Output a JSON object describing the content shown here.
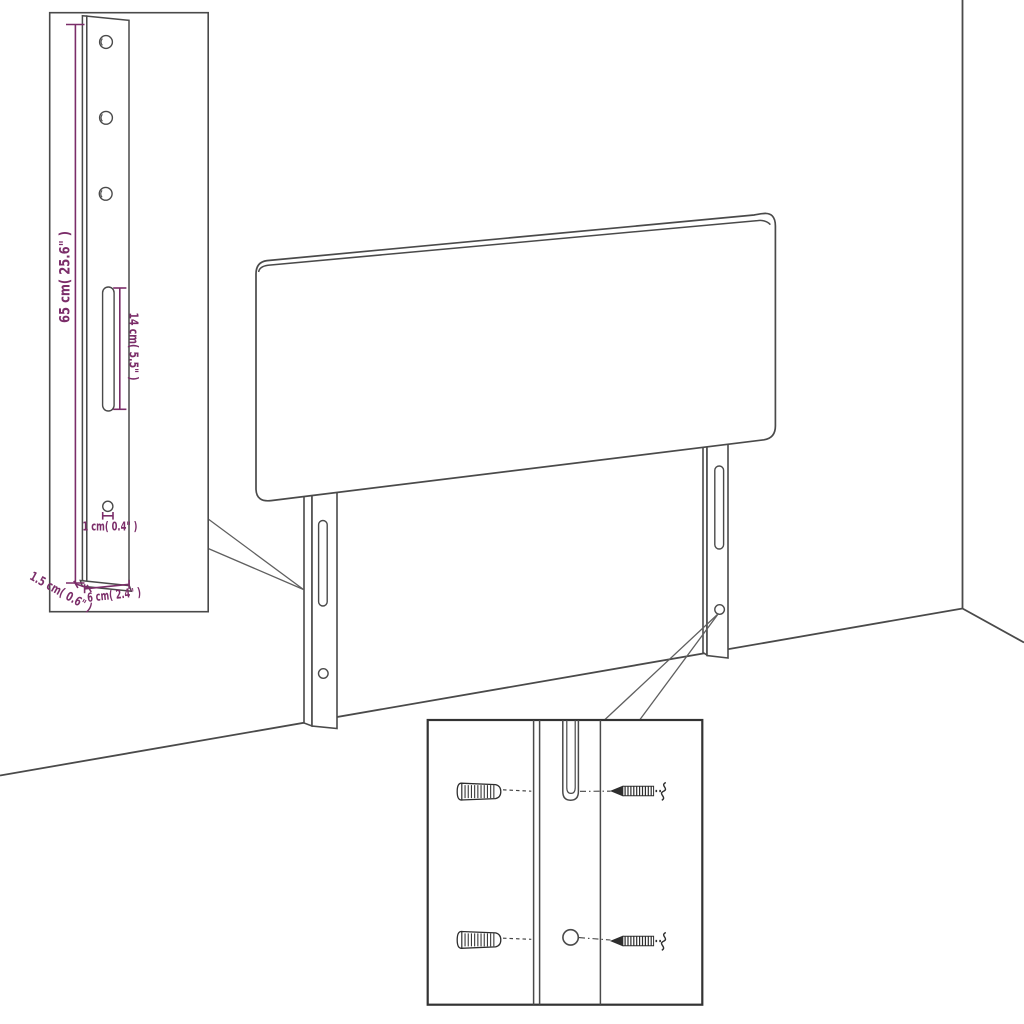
{
  "diagram": {
    "background_color": "#ffffff",
    "line_color": "#4a4a4a",
    "dimension_color": "#7b2d69",
    "dimension_inset": {
      "bracket_height_label": "65 cm( 25.6\" )",
      "slot_length_label": "14 cm( 5.5\" )",
      "hole_diameter_label": "1 cm( 0.4\" )",
      "bracket_depth_label": "1.5 cm( 0.6\" )",
      "bracket_width_label": "6 cm( 2.4\" )"
    }
  }
}
